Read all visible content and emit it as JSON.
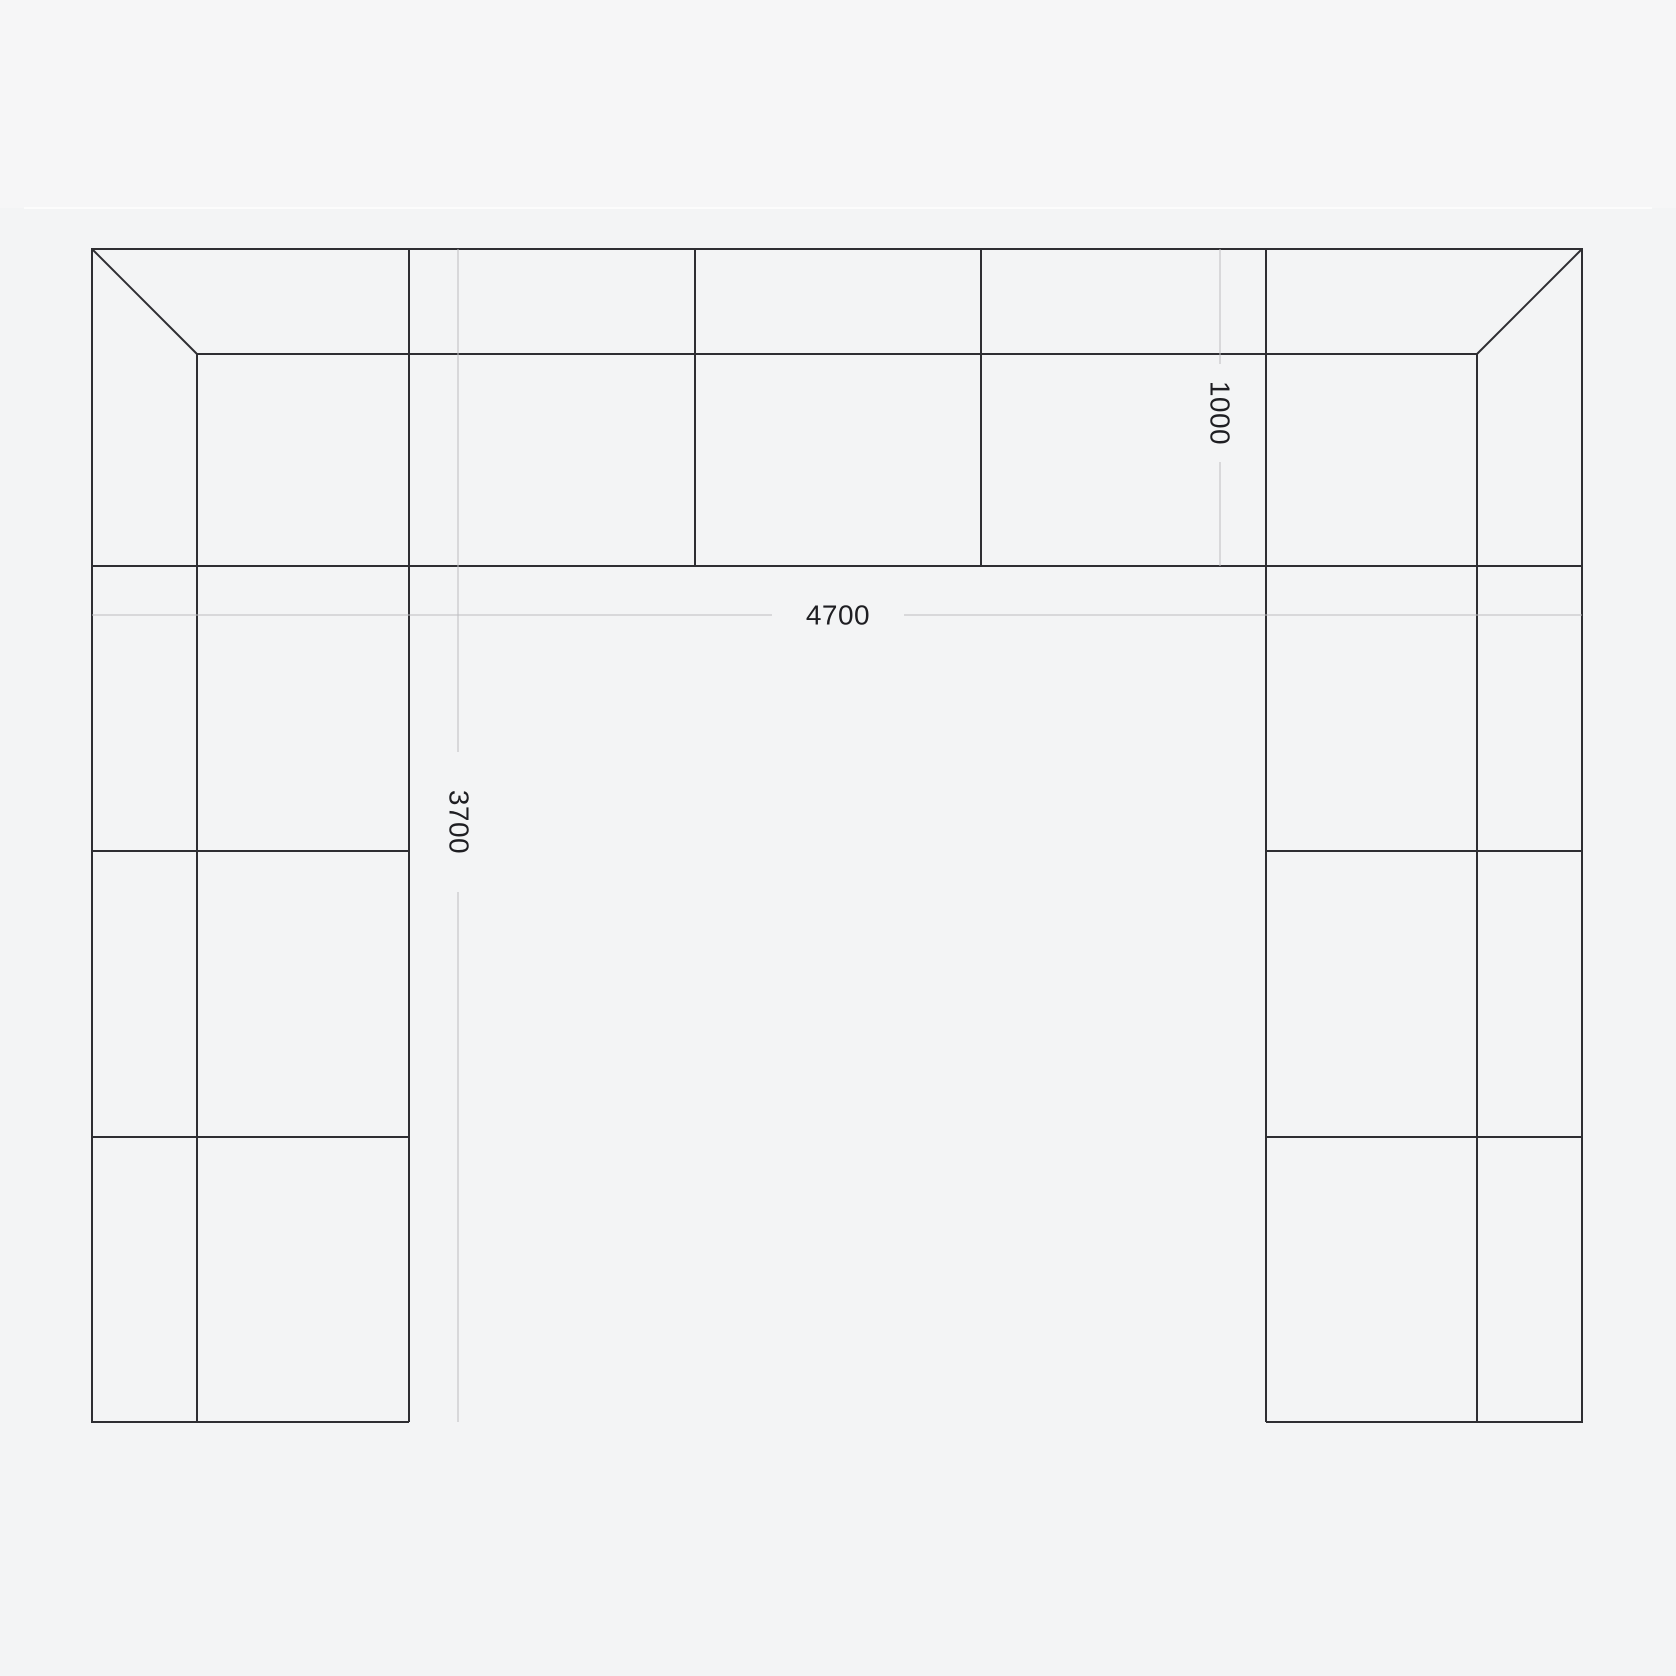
{
  "page": {
    "background": "#f3f4f5",
    "top_strip_background": "#f6f6f7",
    "top_divider_color": "#fcfcfc"
  },
  "drawing": {
    "type": "u-shaped-modular-layout-plan",
    "outline_color": "#2e2e32",
    "dimension_line_color": "#bcbcc0",
    "label_color": "#1e1e22",
    "module_counts": {
      "top_row_modules": 3,
      "top_row_corner_modules": 2,
      "left_column_modules": 3,
      "right_column_modules": 3
    },
    "dimensions": {
      "overall_width": "4700",
      "overall_depth": "3700",
      "module_depth": "1000"
    }
  }
}
